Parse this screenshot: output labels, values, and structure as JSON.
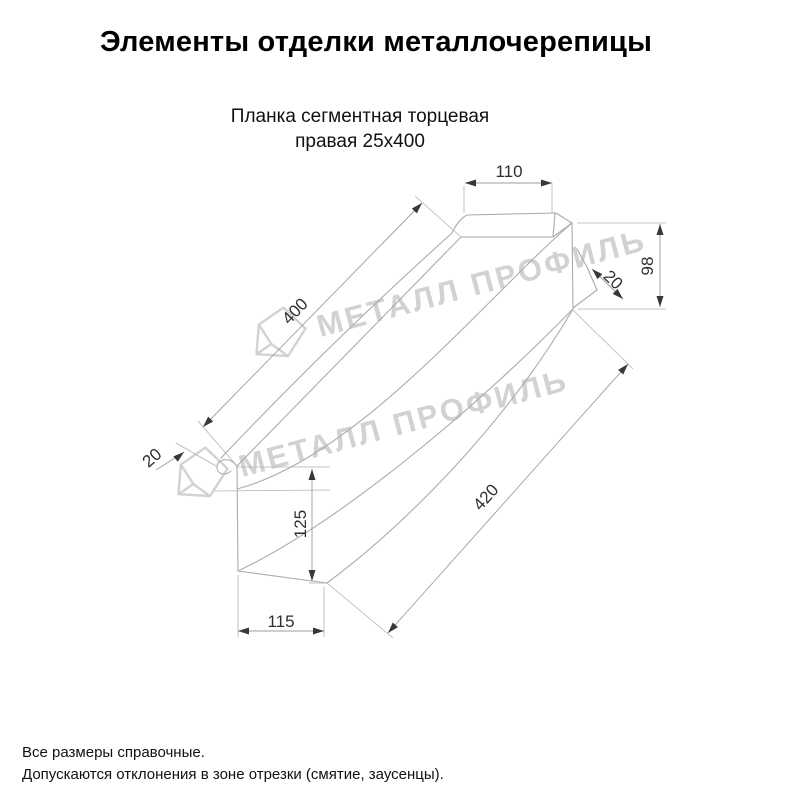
{
  "page": {
    "title": "Элементы отделки металлочерепицы"
  },
  "drawing": {
    "subtitle_line1": "Планка сегментная торцевая",
    "subtitle_line2": "правая 25х400",
    "watermark_text": "МЕТАЛЛ ПРОФИЛЬ",
    "dimensions": {
      "top_flange_width": {
        "value": 110,
        "label": "110"
      },
      "top_edge_length": {
        "value": 400,
        "label": "400"
      },
      "right_end_height": {
        "value": 98,
        "label": "98"
      },
      "right_hem_width": {
        "value": 20,
        "label": "20"
      },
      "left_hem_width": {
        "value": 20,
        "label": "20"
      },
      "left_end_height": {
        "value": 125,
        "label": "125"
      },
      "bottom_flange_width": {
        "value": 115,
        "label": "115"
      },
      "bottom_edge_length": {
        "value": 420,
        "label": "420"
      }
    }
  },
  "footer": {
    "line1": "Все размеры справочные.",
    "line2": "Допускаются отклонения в зоне отрезки (смятие, заусенцы)."
  },
  "colors": {
    "background": "#ffffff",
    "part_line": "#ababab",
    "dimension_line": "#9e9e9e",
    "dimension_text": "#2f2f2f",
    "title_text": "#000000",
    "watermark": "#d2d2d2"
  }
}
